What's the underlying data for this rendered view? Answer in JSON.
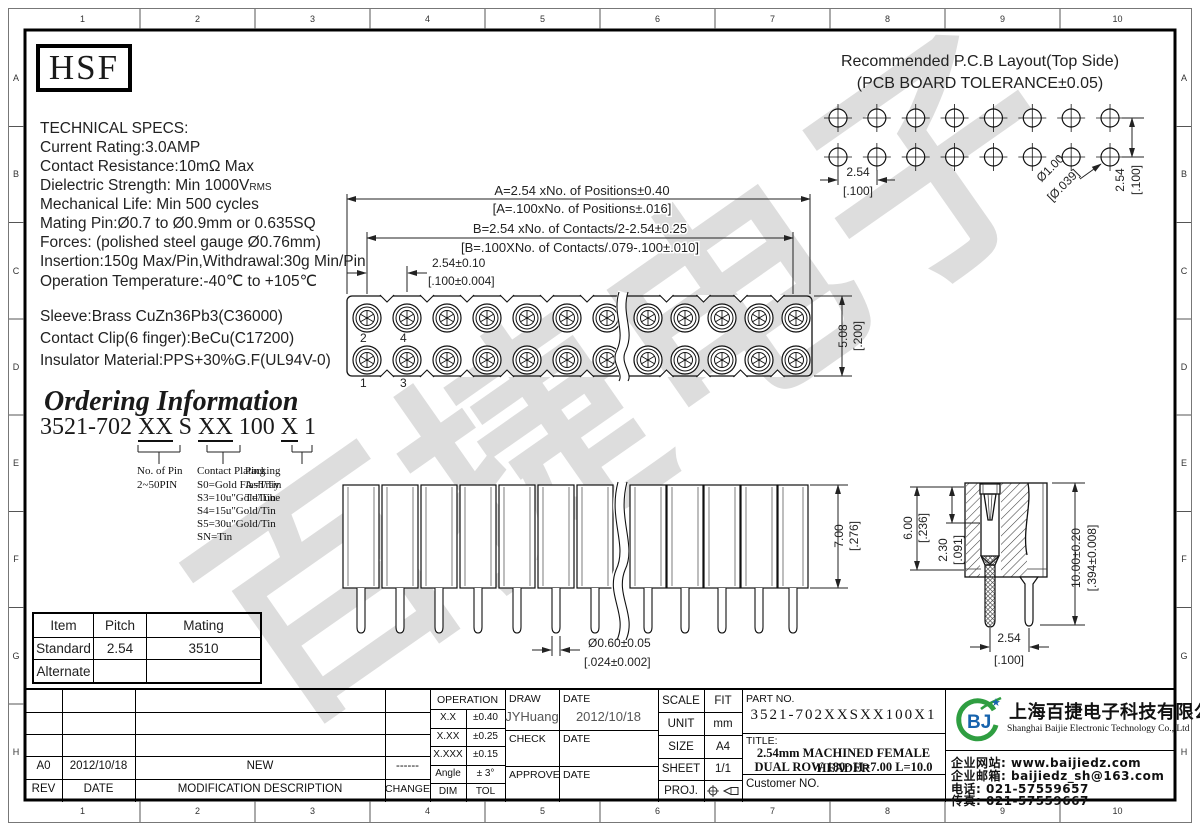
{
  "frame": {
    "cols": [
      "1",
      "2",
      "3",
      "4",
      "5",
      "6",
      "7",
      "8",
      "9",
      "10"
    ],
    "rows": [
      "A",
      "B",
      "C",
      "D",
      "E",
      "F",
      "G",
      "H"
    ]
  },
  "watermark": "百捷电子",
  "logo": "HSF",
  "specs": {
    "title": "TECHNICAL SPECS:",
    "line1": "Current Rating:3.0AMP",
    "line2": "Contact Resistance:10mΩ Max",
    "line3_base": "Dielectric Strength: Min 1000V",
    "line3_sub": "RMS",
    "line4": "Mechanical Life: Min 500 cycles",
    "line5": "Mating Pin:Ø0.7 to Ø0.9mm or 0.635SQ",
    "line6": "Forces: (polished steel gauge Ø0.76mm)",
    "line7": "Insertion:150g Max/Pin,Withdrawal:30g Min/Pin",
    "line8": "Operation Temperature:-40℃ to +105℃",
    "mat1": "Sleeve:Brass CuZn36Pb3(C36000)",
    "mat2": "Contact Clip(6 finger):BeCu(C17200)",
    "mat3": "Insulator Material:PPS+30%G.F(UL94V-0)"
  },
  "ordering": {
    "title": "Ordering Information",
    "p1": "3521-702 ",
    "u1": "XX",
    "p2": " S ",
    "u2": "XX",
    "p3": " 100 ",
    "u3": "X",
    "p4": " 1",
    "pin_title": "No. of Pin",
    "pin_value": "2~50PIN",
    "plating_title": "Contact Plating",
    "plating_opts": [
      "S0=Gold Flash/Tin",
      "S3=10u\"Gold/Tin",
      "S4=15u\"Gold/Tin",
      "S5=30u\"Gold/Tin",
      "SN=Tin"
    ],
    "packing_title": "Packing",
    "packing_opts": [
      "A=Tray",
      "T=Tube"
    ]
  },
  "pcb": {
    "title1": "Recommended P.C.B Layout(Top Side)",
    "title2": "(PCB BOARD TOLERANCE±0.05)",
    "pitch_mm": "2.54",
    "pitch_in": "[.100]",
    "hole_mm": "Ø1.00",
    "hole_in": "[Ø.039]",
    "row_mm": "2.54",
    "row_in": "[.100]"
  },
  "top_view": {
    "dim_a1": "A=2.54 xNo. of Positions±0.40",
    "dim_a2": "[A=.100xNo. of Positions±.016]",
    "dim_b1": "B=2.54 xNo. of Contacts/2-2.54±0.25",
    "dim_b2": "[B=.100XNo. of Contacts/.079-.100±.010]",
    "dim_p1": "2.54±0.10",
    "dim_p2": "[.100±0.004]",
    "dim_h1": "5.08",
    "dim_h2": "[.200]",
    "pin2": "2",
    "pin4": "4",
    "pin1": "1",
    "pin3": "3"
  },
  "side_view": {
    "dim_h1": "7.00",
    "dim_h2": "[.276]",
    "dim_d1": "Ø0.60±0.05",
    "dim_d2": "[.024±0.002]"
  },
  "section_view": {
    "dim1a": "6.00",
    "dim1b": "[.236]",
    "dim2a": "2.30",
    "dim2b": "[.091]",
    "dim3a": "10.00±0.20",
    "dim3b": "[.394±0.008]",
    "dim4a": "2.54",
    "dim4b": "[.100]"
  },
  "mating_table": {
    "headers": [
      "Item",
      "Pitch",
      "Mating"
    ],
    "rows": [
      [
        "Standard",
        "2.54",
        "3510"
      ],
      [
        "Alternate",
        "",
        ""
      ]
    ]
  },
  "revision": {
    "rev": "A0",
    "date": "2012/10/18",
    "desc": "NEW",
    "change": "------",
    "f_rev": "REV",
    "f_date": "DATE",
    "f_desc": "MODIFICATION DESCRIPTION",
    "f_change": "CHANGE"
  },
  "tolerance": {
    "header": "OPERATION",
    "r1a": "X.X",
    "r1b": "±0.40",
    "r2a": "X.XX",
    "r2b": "±0.25",
    "r3a": "X.XXX",
    "r3b": "±0.15",
    "r4a": "Angle",
    "r4b": "± 3°",
    "r5a": "DIM",
    "r5b": "TOL"
  },
  "sign": {
    "draw": "DRAW",
    "draw_name": "JYHuang",
    "date1": "DATE",
    "draw_date": "2012/10/18",
    "check": "CHECK",
    "date2": "DATE",
    "approve": "APPROVE",
    "date3": "DATE"
  },
  "meta": {
    "scale_l": "SCALE",
    "scale_v": "FIT",
    "unit_l": "UNIT",
    "unit_v": "mm",
    "size_l": "SIZE",
    "size_v": "A4",
    "sheet_l": "SHEET",
    "sheet_v": "1/1",
    "proj_l": "PROJ."
  },
  "part": {
    "label": "PART NO.",
    "value": "3521-702XXSXX100X1",
    "title_label": "TITLE:",
    "t1": "2.54mm MACHINED FEMALE HEADER",
    "t2": "DUAL ROW 180° H=7.00 L=10.0",
    "customer": "Customer NO."
  },
  "company": {
    "logo_text": "BJ",
    "star": "★",
    "cn": "上海百捷电子科技有限公司",
    "en": "Shanghai Baijie Electronic Technology Co., Ltd",
    "c1": "企业网站: www.baijiedz.com",
    "c2": "企业邮箱: baijiedz_sh@163.com",
    "c3": "电话: 021-57559657",
    "c4": "传真: 021-57559667"
  }
}
